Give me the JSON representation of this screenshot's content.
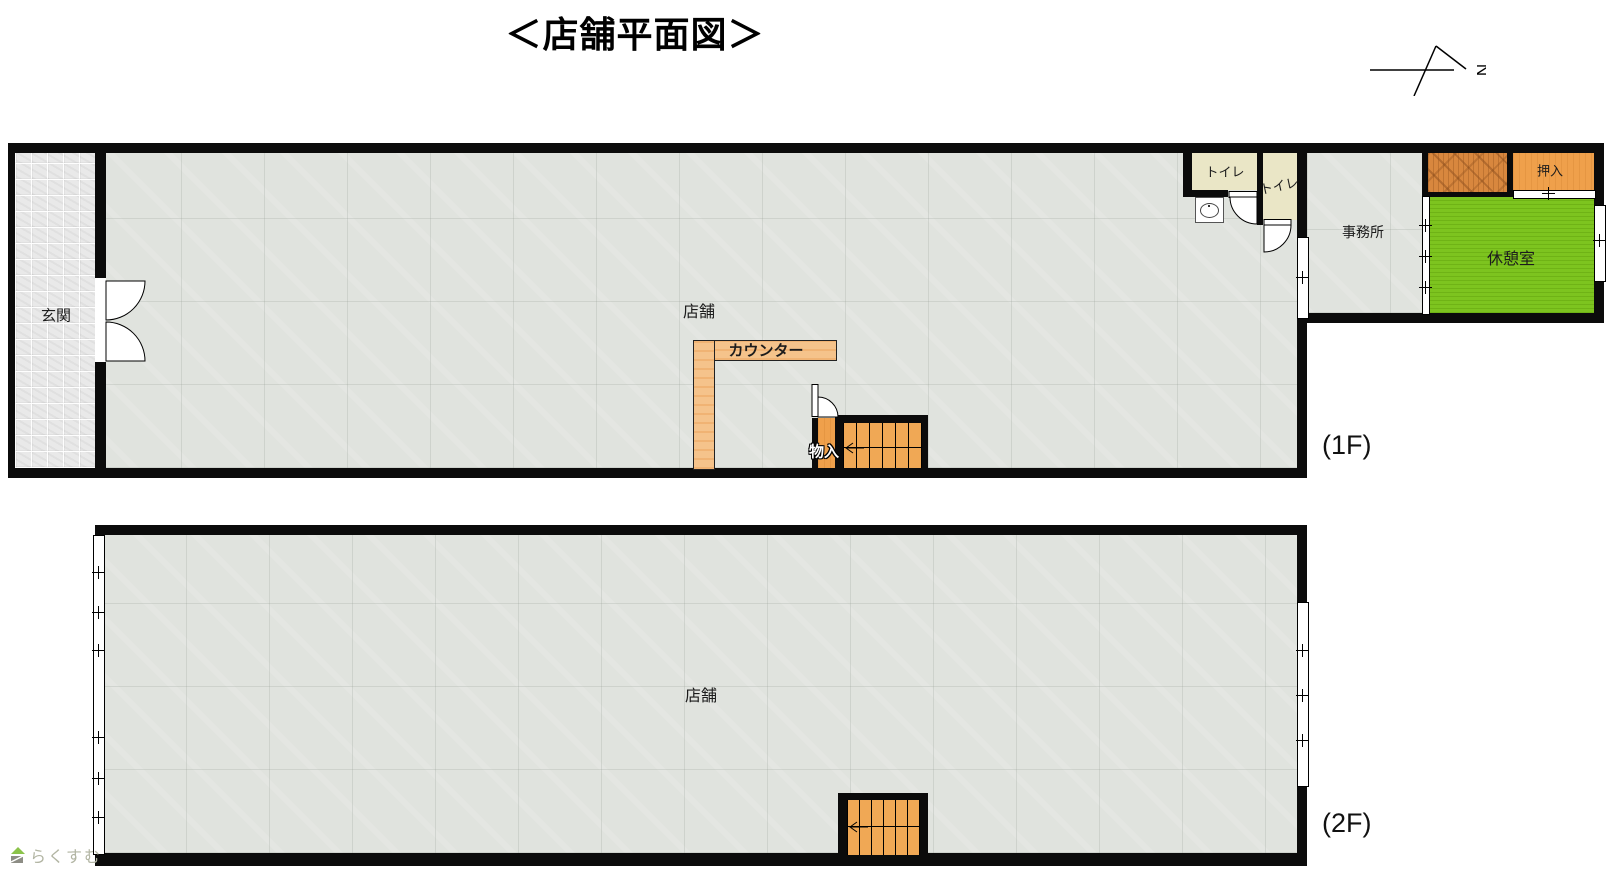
{
  "title": "＜店舗平面図＞",
  "north": {
    "mark": "N"
  },
  "floor1": {
    "label": "(1F)",
    "rooms": {
      "entrance": "玄関",
      "store": "店舗",
      "counter": "カウンター",
      "storage": "物入",
      "toilet_a": "トイレ",
      "toilet_b": "トイレ",
      "office": "事務所",
      "closet": "押入",
      "break_room": "休憩室"
    }
  },
  "floor2": {
    "label": "(2F)",
    "rooms": {
      "store": "店舗"
    }
  },
  "logo": {
    "text": "らくすむ"
  },
  "colors": {
    "wall": "#0b0b0b",
    "floor": "#e0e3de",
    "tile": "#e9e9e9",
    "cream": "#eae6c6",
    "tatami": "#7dc41f",
    "counter": "#f5c38b",
    "stair": "#f0a855",
    "closet_orange": "#efa04b",
    "closet_wood": "#d8873e",
    "logo_green": "#8bc34a",
    "logo_text": "#b2b5a3"
  }
}
